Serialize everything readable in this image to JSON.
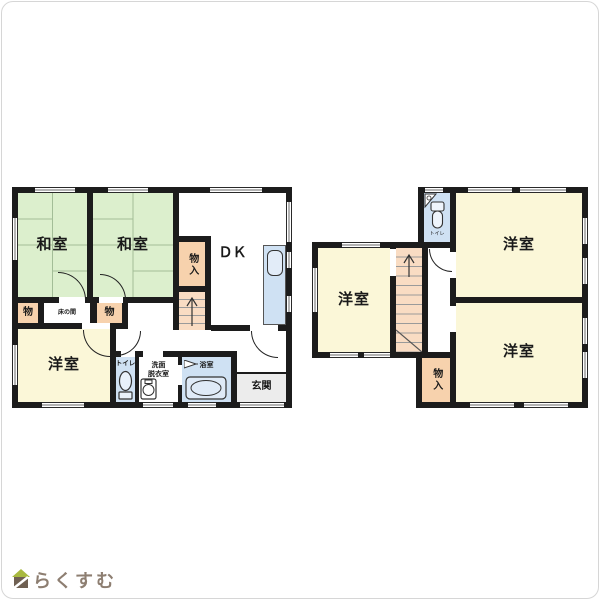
{
  "floor1": {
    "washitsu1": "和室",
    "washitsu2": "和室",
    "dk": "ＤＫ",
    "monoire": "物入",
    "mono_left": "物",
    "tokonoma": "床の間",
    "mono_right": "物",
    "yoshitsu": "洋室",
    "toilet": "トイレ",
    "senmen1": "洗面",
    "senmen2": "脱衣室",
    "bath": "浴室",
    "genkan": "玄関"
  },
  "floor2": {
    "yoshitsu_left": "洋室",
    "yoshitsu_top": "洋室",
    "yoshitsu_bottom": "洋室",
    "monoire": "物入",
    "toilet": "トイレ"
  },
  "logo": {
    "text": "らくすむ"
  },
  "colors": {
    "wall": "#1c1c1c",
    "tatami": "#dcefcd",
    "tatami_line": "#a3bd97",
    "western_room": "#fbf7d8",
    "storage": "#f7d2ad",
    "stairs": "#f9dcc3",
    "water_area": "#cfe1f3",
    "entrance": "#ececec",
    "logo_text": "#8d7e71",
    "logo_roof": "#a8b93f",
    "logo_body": "#6f6052"
  }
}
